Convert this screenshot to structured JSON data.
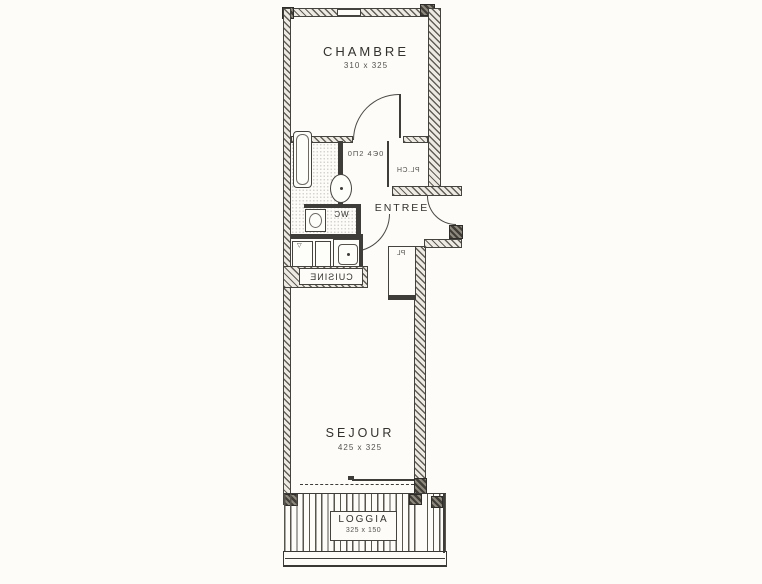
{
  "rooms": {
    "chambre": {
      "name": "CHAMBRE",
      "dimensions": "310 x 325"
    },
    "entree": {
      "name": "ENTREE"
    },
    "sejour": {
      "name": "SEJOUR",
      "dimensions": "425 x 325"
    },
    "loggia": {
      "name": "LOGGIA",
      "dimensions": "325 x 150"
    },
    "cuisine": {
      "name": "CUISINE"
    },
    "wc": {
      "name": "WC"
    }
  },
  "annotations": {
    "hall_dimensions": "0Π2   4Э0",
    "closet_hall": "PL.CH",
    "closet_entree": "PL",
    "kitchen_mark": "▽"
  },
  "colors": {
    "ink": "#3f3d39",
    "wall_fill": "#eceae3",
    "paper": "#fdfcf9"
  }
}
